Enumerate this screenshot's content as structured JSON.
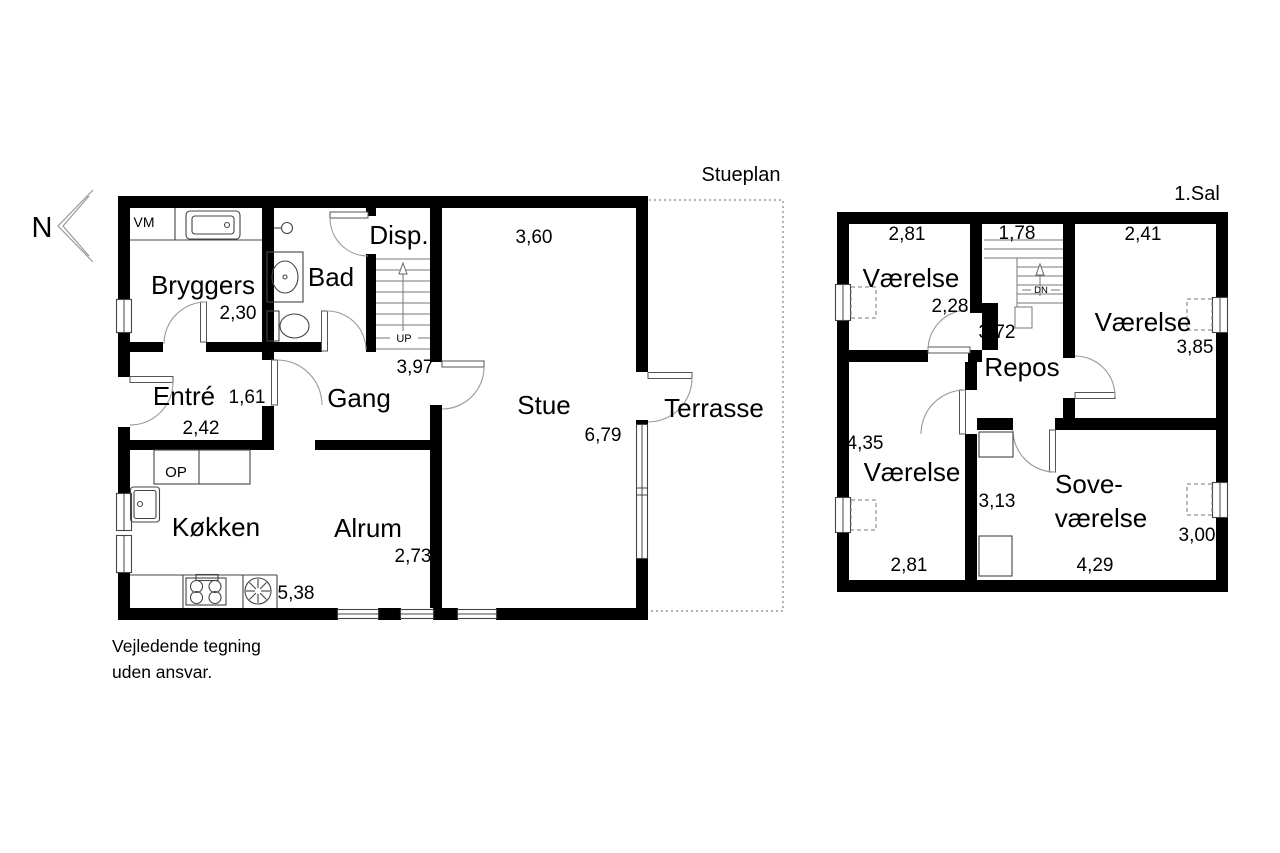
{
  "page": {
    "bg": "#ffffff",
    "ink": "#000000"
  },
  "plan_left": {
    "title": "Stueplan",
    "rooms": {
      "bryggers": {
        "name": "Bryggers",
        "dim": "2,30"
      },
      "bad": {
        "name": "Bad"
      },
      "disp": {
        "name": "Disp."
      },
      "entre": {
        "name": "Entré",
        "dim": "1,61",
        "dim2": "2,42"
      },
      "gang": {
        "name": "Gang",
        "dim": "3,97"
      },
      "stue": {
        "name": "Stue",
        "dim_top": "3,60",
        "dim_side": "6,79"
      },
      "terrasse": {
        "name": "Terrasse"
      },
      "kokken": {
        "name": "Køkken",
        "dim": "5,38"
      },
      "alrum": {
        "name": "Alrum",
        "dim": "2,73"
      }
    },
    "labels": {
      "washing_machine": "VM",
      "oven_cabinet": "OP",
      "stairs_up": "UP"
    }
  },
  "plan_right": {
    "title": "1.Sal",
    "rooms": {
      "vaerelse_nw": {
        "name": "Værelse",
        "dim_top": "2,81",
        "dim_side": "2,28"
      },
      "stair_hall": {
        "dim_top": "1,78",
        "stairs_down": "DN"
      },
      "vaerelse_ne": {
        "name": "Værelse",
        "dim_top": "2,41",
        "dim_side": "3,85"
      },
      "repos": {
        "name": "Repos",
        "dim": "3,72"
      },
      "vaerelse_sw": {
        "name": "Værelse",
        "dim_side": "4,35",
        "dim_bottom": "2,81"
      },
      "sovevaerelse": {
        "name_line1": "Sove-",
        "name_line2": "værelse",
        "dim_side": "3,00",
        "dim_bottom": "4,29",
        "dim_entry": "3,13"
      }
    }
  },
  "compass": {
    "north_label": "N"
  },
  "disclaimer": {
    "line1": "Vejledende tegning",
    "line2": "uden ansvar."
  }
}
